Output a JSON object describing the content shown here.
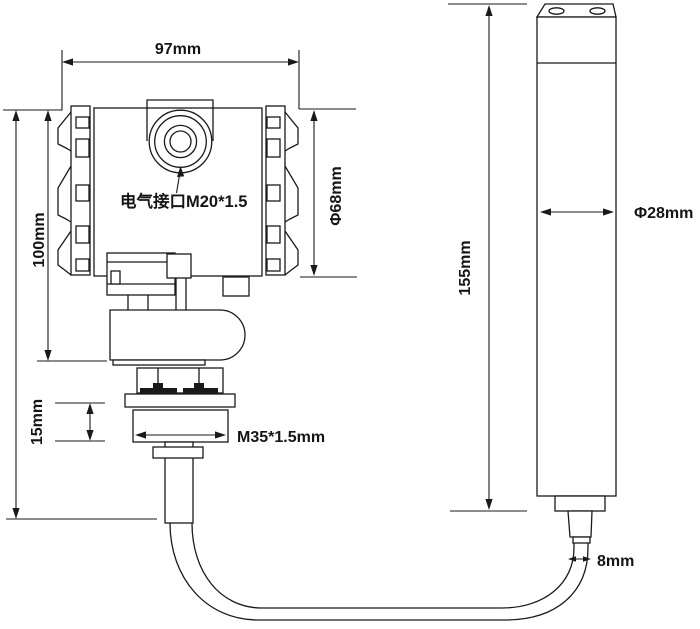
{
  "drawing": {
    "type": "technical-dimension-diagram",
    "background_color": "#ffffff",
    "line_color": "#1a1a1a",
    "transmitter": {
      "width": "97mm",
      "height": "100mm",
      "housing_diameter": "Φ68mm",
      "electrical_port": "电气接口M20*1.5",
      "thread_height": "15mm",
      "thread_spec": "M35*1.5mm"
    },
    "probe": {
      "length": "155mm",
      "diameter": "Φ28mm"
    },
    "cable": {
      "diameter": "8mm"
    }
  }
}
